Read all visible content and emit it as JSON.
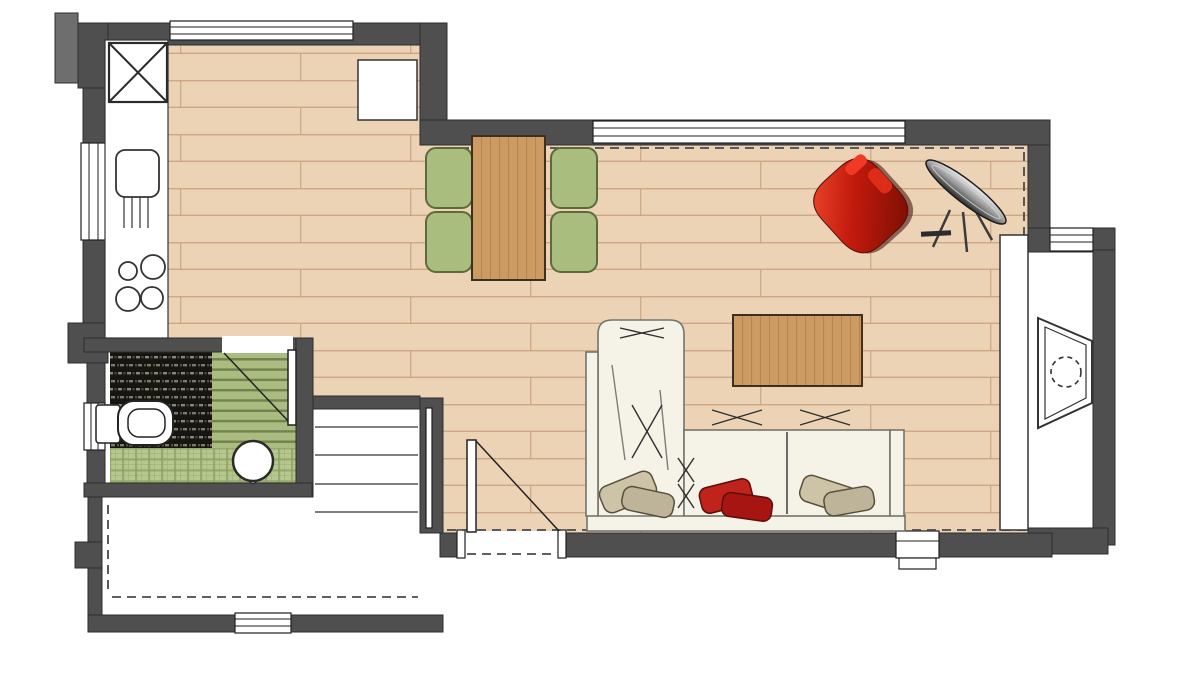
{
  "palette": {
    "wall": "#4f4f4f",
    "wall_light": "#6e6e6e",
    "wood_base": "#ecd3b6",
    "wood_line": "#c59d78",
    "wood_table": "#cc9a63",
    "wood_table_line": "#a8763b",
    "chair_green": "#a8bd7e",
    "chair_border": "#5f6a3c",
    "sofa_cream": "#f5f3e8",
    "sofa_line": "#74746a",
    "pillow_beige": "#cdc3a6",
    "pillow_beige2": "#beb49a",
    "pillow_red": "#c0221c",
    "pillow_red2": "#a61512",
    "armchair_red_light": "#ef4a2e",
    "armchair_red_dark": "#7c0e04",
    "tile_dark": "#171512",
    "tile_dot": "#96967e",
    "tile_green": "#aabc80",
    "tile_green_dark": "#6f7d4a",
    "plaid_green": "#b7c78f",
    "plaid_line": "#8ba061",
    "dash": "#4a4a4a"
  },
  "objects": {
    "plan": "apartment floor plan",
    "kitchen_counter": "kitchen counter",
    "tall_unit": "tall kitchen unit marked with X",
    "sink": "kitchen sink with drainer",
    "cooktop": "cooktop with four burners",
    "dining_table": "wooden dining table",
    "dining_chairs": "4 green dining chairs",
    "coffee_table": "wooden coffee table",
    "sofa": "L-shaped cream sofa with cushions",
    "pillows": "throw pillows (beige and red)",
    "armchair": "red swivel armchair",
    "floor_lamp": "designer floor lamp",
    "fireplace": "fireplace / TV unit in wall niche",
    "cabinet": "tall white cabinet",
    "toilet": "toilet",
    "basin": "round washbasin",
    "bathroom_door": "bathroom door with swing",
    "entry_door": "entry door with swing",
    "stairs": "staircase treads",
    "windows": "windows in exterior walls",
    "shaft": "shaft / duct niche"
  }
}
